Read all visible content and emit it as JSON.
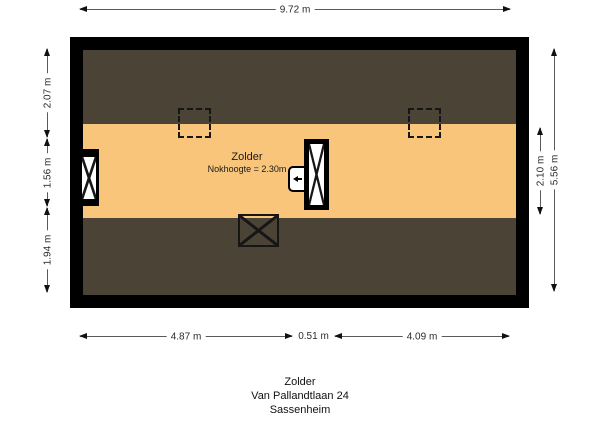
{
  "page": {
    "background": "#ffffff"
  },
  "plan": {
    "room_label": "Zolder",
    "ridge_label": "Nokhoogte = 2.30m",
    "colors": {
      "wall": "#000000",
      "roof_slope": "#4a4336",
      "floor": "#f8c57b"
    },
    "symbols": [
      {
        "name": "window-icon",
        "desc": "crossed window in left wall"
      },
      {
        "name": "stairs-icon",
        "desc": "stair opening with cross"
      },
      {
        "name": "ventilation-unit-icon",
        "desc": "small unit with left arrow"
      },
      {
        "name": "skylight-icon",
        "desc": "crossed rectangle in lower roof slope"
      },
      {
        "name": "roof-window-outline",
        "desc": "dashed square outline (2x)"
      }
    ]
  },
  "dimensions": {
    "top": {
      "label": "9.72 m"
    },
    "left": [
      {
        "label": "2.07 m"
      },
      {
        "label": "1.56 m"
      },
      {
        "label": "1.94 m"
      }
    ],
    "right": [
      {
        "label": "2.10 m"
      },
      {
        "label": "5.56 m"
      }
    ],
    "bottom": [
      {
        "label": "4.87 m"
      },
      {
        "label": "0.51 m"
      },
      {
        "label": "4.09 m"
      }
    ]
  },
  "footer": {
    "lines": [
      "Zolder",
      "Van Pallandtlaan 24",
      "Sassenheim"
    ]
  }
}
